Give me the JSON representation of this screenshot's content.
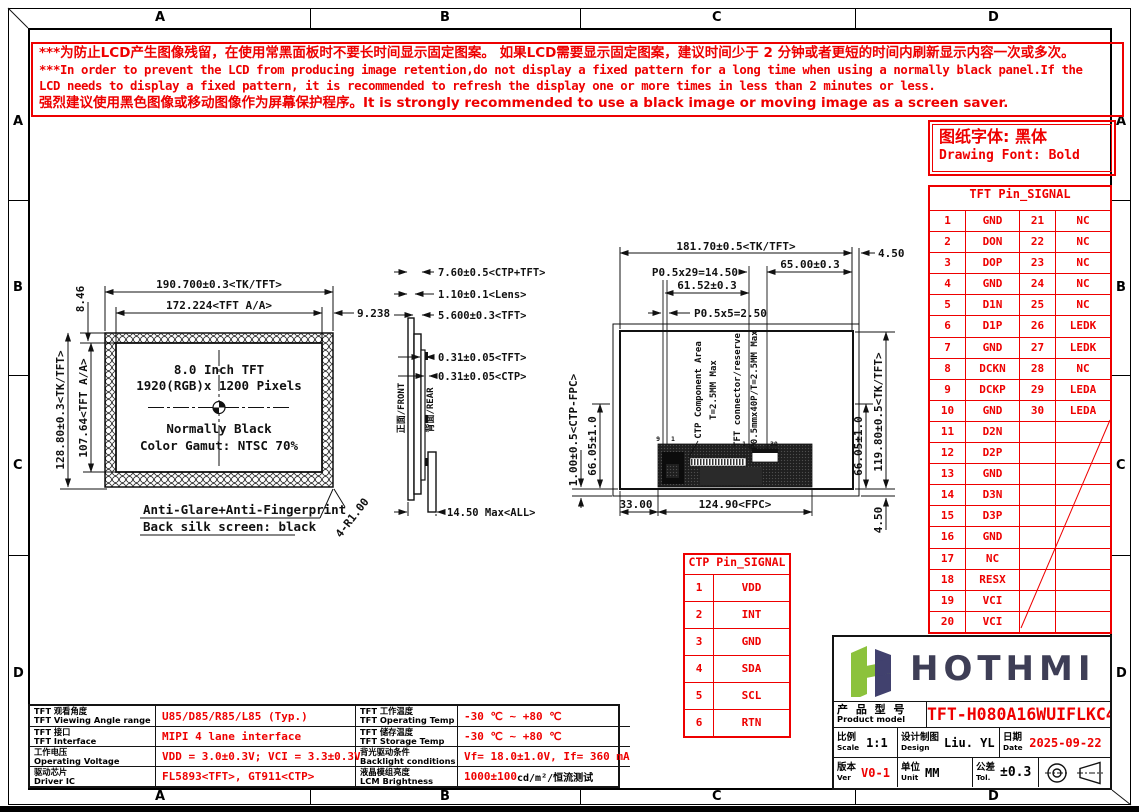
{
  "border": {
    "letters": [
      "A",
      "B",
      "C",
      "D"
    ]
  },
  "warning": {
    "line1": "***为防止LCD产生图像残留，在使用常黑面板时不要长时间显示固定图案。 如果LCD需要显示固定图案，建议时间少于 2 分钟或者更短的时间内刷新显示内容一次或多次。",
    "line2": "***In order to prevent the LCD from producing image retention,do not display a fixed pattern for a long time when using a normally black panel.If the",
    "line3": " LCD needs to display a fixed pattern, it is recommended to refresh the display one or more times in less than 2 minutes or less.",
    "line4": "强烈建议使用黑色图像或移动图像作为屏幕保护程序。It is strongly recommended to use a black image or moving image as a screen saver."
  },
  "font_note": {
    "cn": "图纸字体: 黑体",
    "en": "Drawing Font: Bold"
  },
  "tft_pin_table": {
    "title": "TFT Pin_SIGNAL",
    "rows": [
      [
        "1",
        "GND",
        "21",
        "NC"
      ],
      [
        "2",
        "DON",
        "22",
        "NC"
      ],
      [
        "3",
        "DOP",
        "23",
        "NC"
      ],
      [
        "4",
        "GND",
        "24",
        "NC"
      ],
      [
        "5",
        "D1N",
        "25",
        "NC"
      ],
      [
        "6",
        "D1P",
        "26",
        "LEDK"
      ],
      [
        "7",
        "GND",
        "27",
        "LEDK"
      ],
      [
        "8",
        "DCKN",
        "28",
        "NC"
      ],
      [
        "9",
        "DCKP",
        "29",
        "LEDA"
      ],
      [
        "10",
        "GND",
        "30",
        "LEDA"
      ],
      [
        "11",
        "D2N",
        "",
        ""
      ],
      [
        "12",
        "D2P",
        "",
        ""
      ],
      [
        "13",
        "GND",
        "",
        ""
      ],
      [
        "14",
        "D3N",
        "",
        ""
      ],
      [
        "15",
        "D3P",
        "",
        ""
      ],
      [
        "16",
        "GND",
        "",
        ""
      ],
      [
        "17",
        "NC",
        "",
        ""
      ],
      [
        "18",
        "RESX",
        "",
        ""
      ],
      [
        "19",
        "VCI",
        "",
        ""
      ],
      [
        "20",
        "VCI",
        "",
        ""
      ]
    ]
  },
  "ctp_pin_table": {
    "title": "CTP Pin_SIGNAL",
    "rows": [
      [
        "1",
        "VDD"
      ],
      [
        "2",
        "INT"
      ],
      [
        "3",
        "GND"
      ],
      [
        "4",
        "SDA"
      ],
      [
        "5",
        "SCL"
      ],
      [
        "6",
        "RTN"
      ]
    ]
  },
  "front_view": {
    "dim_width_tk": "190.700±0.3<TK/TFT>",
    "dim_width_aa": "172.224<TFT A/A>",
    "dim_right_margin": "9.238",
    "dim_top_margin": "8.46",
    "dim_height_tk": "128.80±0.3<TK/TFT>",
    "dim_height_aa": "107.64<TFT A/A>",
    "line1": "8.0 Inch TFT",
    "line2": "1920(RGB)x 1200 Pixels",
    "line3": "Normally Black",
    "line4": "Color Gamut: NTSC 70%",
    "note1": "Anti-Glare+Anti-Fingerprint",
    "note2": "Back silk screen: black",
    "corner_radius": "4-R1.00"
  },
  "side_view": {
    "dim1": "7.60±0.5<CTP+TFT>",
    "dim2": "1.10±0.1<Lens>",
    "dim3": "5.600±0.3<TFT>",
    "dim4": "0.31±0.05<TFT>",
    "dim5": "0.31±0.05<CTP>",
    "dim6": "14.50 Max<ALL>",
    "front_label": "正面/FRONT",
    "rear_label": "背面/REAR"
  },
  "back_view": {
    "dim_width": "181.70±0.5<TK/TFT>",
    "dim_right_offset": "4.50",
    "dim_pitch30": "P0.5x29=14.50",
    "dim_65": "65.00±0.3",
    "dim_6152": "61.52±0.3",
    "dim_pitch6": "P0.5x5=2.50",
    "dim_ctp_fpc": "1.00±0.5<CTP-FPC>",
    "dim_6605_left": "66.05±1.0",
    "dim_6605_right": "66.05±1.0",
    "dim_height": "119.80±0.5<TK/TFT>",
    "dim_bottom_offset": "4.50",
    "dim_33": "33.00",
    "dim_fpc": "124.90<FPC>",
    "label_ctp_area": "CTP Component Area",
    "label_ctp_t": "T=2.5MM Max",
    "label_tft_conn": "TFT connector/reserve",
    "label_tft_t": "P0.5mmx40P/T=2.5MM Max",
    "pin_left_a": "9",
    "pin_left_b": "1",
    "pin_right_a": "1",
    "pin_right_b": "30"
  },
  "spec_table": {
    "rows": [
      {
        "label1_cn": "TFT 观看角度",
        "label1_en": "TFT Viewing Angle range",
        "value1": "U85/D85/R85/L85 (Typ.)",
        "label2_cn": "TFT 工作温度",
        "label2_en": "TFT Operating Temp",
        "value2": "-30 ℃ ~ +80 ℃",
        "value2_suffix": ""
      },
      {
        "label1_cn": "TFT 接口",
        "label1_en": "TFT Interface",
        "value1": "MIPI 4 lane interface",
        "label2_cn": "TFT 储存温度",
        "label2_en": "TFT Storage Temp",
        "value2": "-30 ℃ ~ +80 ℃",
        "value2_suffix": ""
      },
      {
        "label1_cn": "工作电压",
        "label1_en": "Operating Voltage",
        "value1": "VDD = 3.0±0.3V; VCI = 3.3±0.3V",
        "label2_cn": "背光驱动条件",
        "label2_en": "Backlight conditions",
        "value2": "Vf= 18.0±1.0V, If= 360 mA",
        "value2_suffix": ""
      },
      {
        "label1_cn": "驱动芯片",
        "label1_en": "Driver IC",
        "value1": "FL5893<TFT>, GT911<CTP>",
        "label2_cn": "液晶模组亮度",
        "label2_en": "LCM Brightness",
        "value2": "1000±100",
        "value2_suffix": " cd/m²/恒流测试"
      }
    ]
  },
  "title_block": {
    "brand": "HOTHMI",
    "product_label_cn": "产 品 型 号",
    "product_label_en": "Product model",
    "model": "TFT-H080A16WUIFLKC40",
    "scale_cn": "比例",
    "scale_en": "Scale",
    "scale_val": "1:1",
    "design_cn": "设计制图",
    "design_en": "Design",
    "design_val": "Liu. YL",
    "date_cn": "日期",
    "date_en": "Date",
    "date_val": "2025-09-22",
    "ver_cn": "版本",
    "ver_en": "Ver",
    "ver_val": "V0-1",
    "unit_cn": "单位",
    "unit_en": "Unit",
    "unit_val": "MM",
    "tol_cn": "公差",
    "tol_en": "Tol.",
    "tol_val": "±0.3"
  }
}
